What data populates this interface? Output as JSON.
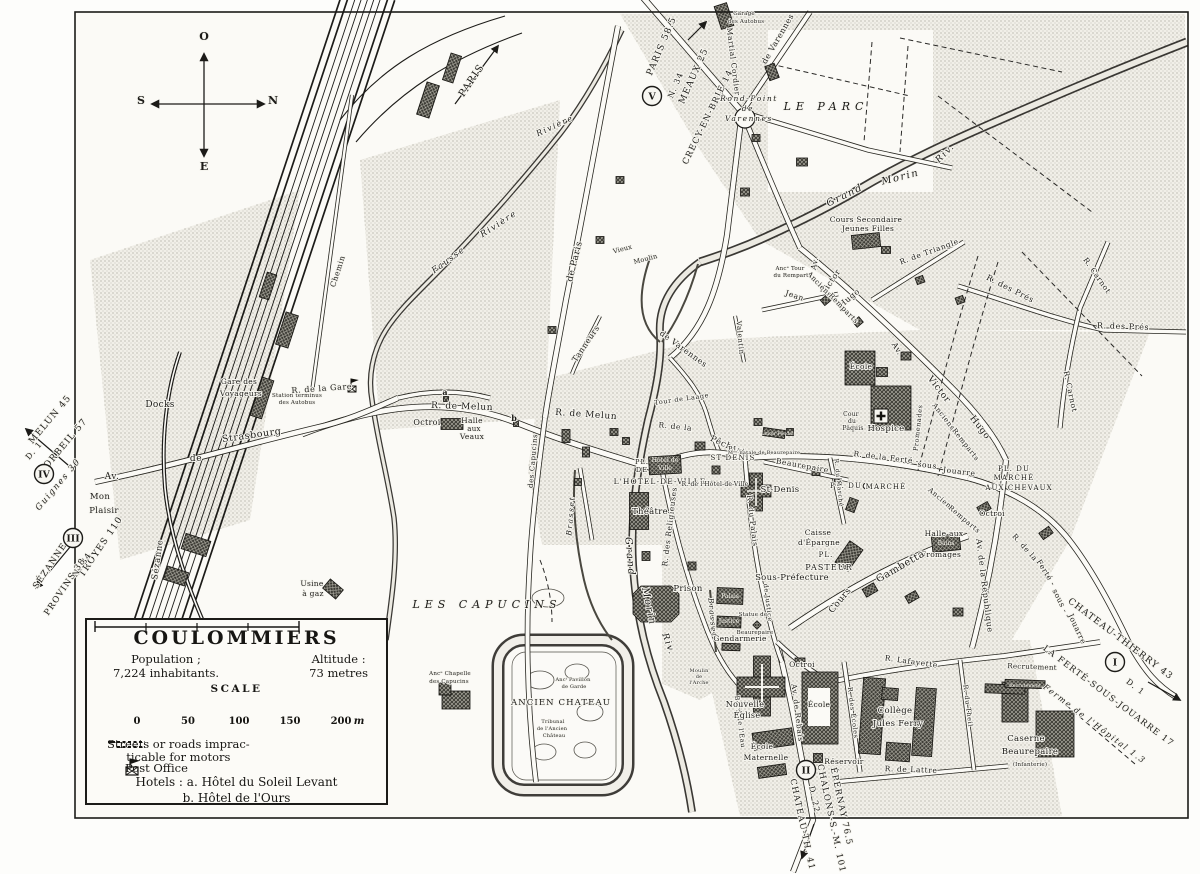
{
  "legend": {
    "title": "COULOMMIERS",
    "population_label": "Population ;",
    "population_value": "7,224 inhabitants.",
    "altitude_label": "Altitude :",
    "altitude_value": "73 metres",
    "scale_label": "SCALE",
    "scale_ticks": [
      "0",
      "50",
      "100",
      "150",
      "200"
    ],
    "scale_unit": "m",
    "impracticable_line1": "Streets or roads imprac-",
    "impracticable_line2": "ticable for motors",
    "post_office": "Post Office",
    "hotels_label": "Hotels :",
    "hotel_a": "a. Hôtel du Soleil Levant",
    "hotel_b": "b. Hôtel de l'Ours"
  },
  "compass": {
    "top": "O",
    "right": "N",
    "left": "S",
    "bottom": "E"
  },
  "map_labels": [
    [
      "MELUN 45",
      52,
      421,
      -50,
      9,
      "rt"
    ],
    [
      "CORBEIL 57",
      65,
      448,
      -50,
      9,
      "rt"
    ],
    [
      "D. 1",
      36,
      452,
      -50,
      8,
      "rt"
    ],
    [
      "Guignes 30",
      60,
      486,
      -50,
      8.5,
      "rv"
    ],
    [
      "TROYES 110",
      103,
      548,
      -56,
      9,
      "rt"
    ],
    [
      "N. 34",
      84,
      566,
      -56,
      8,
      "rt"
    ],
    [
      "SÉZANNE",
      52,
      567,
      -56,
      8.5,
      "rt"
    ],
    [
      "PROVINS 38",
      67,
      588,
      -56,
      8.5,
      "rt"
    ],
    [
      "PARIS 58.5",
      664,
      47,
      -67,
      9,
      "rt"
    ],
    [
      "N. 34",
      678,
      86,
      -67,
      8,
      "rt"
    ],
    [
      "MEAUX 25",
      696,
      77,
      -66,
      9,
      "rt"
    ],
    [
      "CRECY-EN-BRIE 14",
      710,
      118,
      -64,
      8.5,
      "rt"
    ],
    [
      "PARIS",
      474,
      82,
      -56,
      10,
      "rt"
    ],
    [
      "CHATEAU-THIERRY 43",
      1119,
      641,
      37,
      9,
      "rt"
    ],
    [
      "D. 1",
      1134,
      689,
      37,
      8,
      "rt"
    ],
    [
      "LA FERTÉ-SOUS-JOUARRE 17",
      1107,
      698,
      37,
      8.5,
      "rt"
    ],
    [
      "Ferme de l'Hôpital 1.3",
      1093,
      726,
      37,
      8,
      "rv"
    ],
    [
      "D. 22",
      812,
      800,
      78,
      8,
      "rt"
    ],
    [
      "ÉPERNAY 76.5",
      839,
      807,
      78,
      8.5,
      "rt"
    ],
    [
      "CHALONS-S.-M. 101",
      829,
      819,
      78,
      8.5,
      "rt"
    ],
    [
      "CHATEAU-TH. 41",
      800,
      825,
      78,
      8.5,
      "rt"
    ],
    [
      "I",
      1115,
      662,
      0,
      0,
      "cir"
    ],
    [
      "II",
      806,
      770,
      0,
      0,
      "cir"
    ],
    [
      "III",
      73,
      538,
      0,
      0,
      "cir"
    ],
    [
      "IV",
      44,
      474,
      0,
      0,
      "cir"
    ],
    [
      "V",
      652,
      96,
      0,
      0,
      "cir"
    ],
    [
      "O",
      204,
      40,
      0,
      11,
      "cp"
    ],
    [
      "N",
      273,
      104,
      0,
      11,
      "cp"
    ],
    [
      "S",
      141,
      104,
      0,
      11,
      "cp"
    ],
    [
      "E",
      204,
      170,
      0,
      11,
      "cp"
    ],
    [
      "Docks",
      160,
      407,
      0,
      9,
      "pl"
    ],
    [
      "Gare des",
      239,
      384,
      0,
      7.5,
      "pl"
    ],
    [
      "Voyageurs",
      241,
      396,
      0,
      7.5,
      "pl"
    ],
    [
      "Station terminus",
      297,
      397,
      0,
      5.5,
      "tn"
    ],
    [
      "des Autobus",
      297,
      404,
      0,
      5.5,
      "tn"
    ],
    [
      "R. de la Gare",
      322,
      391,
      -4,
      8,
      "rd"
    ],
    [
      "Strasbourg",
      252,
      438,
      -8,
      9.5,
      "rd"
    ],
    [
      "de",
      196,
      461,
      0,
      9,
      "rd"
    ],
    [
      "Av.",
      112,
      479,
      0,
      9,
      "rd"
    ],
    [
      "Mon",
      100,
      499,
      0,
      8.5,
      "pl"
    ],
    [
      "Plaisir",
      104,
      513,
      0,
      8.5,
      "pl"
    ],
    [
      "Sézanne",
      160,
      560,
      -82,
      8.5,
      "rd"
    ],
    [
      "Chemin",
      340,
      272,
      -72,
      7.5,
      "rd"
    ],
    [
      "Usine",
      312,
      586,
      0,
      7.5,
      "pl"
    ],
    [
      "à gaz",
      313,
      596,
      0,
      7.5,
      "pl"
    ],
    [
      "Garage",
      744,
      15,
      0,
      5.5,
      "tn"
    ],
    [
      "des Autobus",
      746,
      23,
      0,
      5.5,
      "tn"
    ],
    [
      "Fausse",
      450,
      262,
      -36,
      8.5,
      "rv"
    ],
    [
      "Rivière",
      500,
      226,
      -33,
      8.5,
      "rv"
    ],
    [
      "Rivière",
      556,
      128,
      -25,
      8,
      "rv"
    ],
    [
      "Grand",
      846,
      198,
      -26,
      10,
      "rv"
    ],
    [
      "Morin",
      901,
      180,
      -14,
      10,
      "rv"
    ],
    [
      "Riv.",
      947,
      155,
      -45,
      9,
      "rv"
    ],
    [
      "Grand",
      627,
      557,
      85,
      10,
      "rv"
    ],
    [
      "Morin",
      646,
      607,
      78,
      10,
      "rv"
    ],
    [
      "Riv.",
      666,
      645,
      70,
      9,
      "rv"
    ],
    [
      "Brasset",
      573,
      516,
      -85,
      7.5,
      "rv"
    ],
    [
      "Brasset",
      710,
      618,
      85,
      7.5,
      "rv"
    ],
    [
      "R.  de  Melun",
      462,
      409,
      2,
      9,
      "rd"
    ],
    [
      "R.  de  Melun",
      586,
      417,
      4,
      9,
      "rd"
    ],
    [
      "Octroi",
      427,
      425,
      0,
      8,
      "pl"
    ],
    [
      "Halle",
      472,
      423,
      0,
      7.5,
      "pl"
    ],
    [
      "aux",
      474,
      431,
      0,
      7,
      "pl"
    ],
    [
      "Veaux",
      472,
      439,
      0,
      7.5,
      "pl"
    ],
    [
      "a",
      445,
      395,
      0,
      8,
      "bd"
    ],
    [
      "b",
      514,
      421,
      0,
      8,
      "bd"
    ],
    [
      "de Paris",
      577,
      262,
      -76,
      9,
      "rd"
    ],
    [
      "Vieux",
      623,
      251,
      -15,
      6.5,
      "tn"
    ],
    [
      "Moulin",
      646,
      261,
      -15,
      6.5,
      "tn"
    ],
    [
      "Tanneurs",
      588,
      345,
      -56,
      8,
      "rd"
    ],
    [
      "de Varennes",
      682,
      351,
      36,
      8,
      "rd"
    ],
    [
      "Valentin",
      738,
      338,
      85,
      7,
      "rd"
    ],
    [
      "de Varennes",
      780,
      40,
      -60,
      8,
      "rd"
    ],
    [
      "Martial Cordier",
      731,
      62,
      83,
      7.5,
      "rd"
    ],
    [
      "Rond-Point",
      749,
      101,
      0,
      7.5,
      "rv"
    ],
    [
      "de",
      748,
      111,
      0,
      7.5,
      "rv"
    ],
    [
      "Varennes",
      749,
      121,
      0,
      7.5,
      "rv"
    ],
    [
      "LE PARC",
      826,
      110,
      0,
      11,
      "big"
    ],
    [
      "Cours Secondaire",
      866,
      222,
      0,
      7.5,
      "pl"
    ],
    [
      "Jeunes Filles",
      868,
      231,
      0,
      7.5,
      "pl"
    ],
    [
      "Av.",
      817,
      264,
      -78,
      7.5,
      "rd"
    ],
    [
      "Victor",
      833,
      283,
      -56,
      8,
      "rd"
    ],
    [
      "Hugo",
      851,
      300,
      -40,
      8,
      "rd"
    ],
    [
      "Anciens",
      818,
      286,
      46,
      7,
      "rd"
    ],
    [
      "Remparts",
      842,
      310,
      46,
      7,
      "rd"
    ],
    [
      "Jean",
      794,
      298,
      18,
      7.5,
      "rd"
    ],
    [
      "Ancᵉ Tour",
      790,
      270,
      0,
      5.5,
      "tn"
    ],
    [
      "du Rempart",
      791,
      277,
      0,
      5.5,
      "tn"
    ],
    [
      "R. de Triangle",
      930,
      254,
      -20,
      7.5,
      "rd"
    ],
    [
      "R. des Prés",
      1009,
      291,
      27,
      8,
      "rd"
    ],
    [
      "R. des Prés",
      1123,
      329,
      2,
      8,
      "rd"
    ],
    [
      "R. Carnot",
      1095,
      277,
      55,
      7.5,
      "rd"
    ],
    [
      "R. Carnot",
      1068,
      392,
      78,
      7.5,
      "rd"
    ],
    [
      "Tour de Laage",
      682,
      401,
      -8,
      6.5,
      "rd"
    ],
    [
      "des Capucins",
      535,
      461,
      -85,
      7,
      "rd"
    ],
    [
      "Hôtel de",
      665,
      462,
      0,
      6.2,
      "wh"
    ],
    [
      "Ville",
      665,
      470,
      0,
      6.2,
      "wh"
    ],
    [
      "PL.",
      642,
      464,
      0,
      6.5,
      "cap"
    ],
    [
      "DE",
      642,
      472,
      0,
      6.5,
      "cap"
    ],
    [
      "L'HOTEL-DE-VILLE",
      660,
      484,
      0,
      7.5,
      "cap"
    ],
    [
      "R. de l'Hôtel-de-Ville",
      715,
      486,
      0,
      6,
      "tn"
    ],
    [
      "Théâtre",
      650,
      514,
      0,
      8.5,
      "pl"
    ],
    [
      "R. de la",
      675,
      429,
      6,
      7.5,
      "rd"
    ],
    [
      "Pêcherie",
      729,
      449,
      24,
      8.5,
      "rd"
    ],
    [
      "PL.",
      735,
      451,
      0,
      6.5,
      "cap"
    ],
    [
      "ST DENIS",
      733,
      460,
      0,
      7,
      "cap"
    ],
    [
      "St-Denis",
      780,
      492,
      0,
      8.5,
      "pl"
    ],
    [
      "R. du Palais",
      750,
      521,
      83,
      7.5,
      "rd"
    ],
    [
      "Beaurepaire",
      802,
      468,
      10,
      7.5,
      "rd"
    ],
    [
      "Manoir Féodal",
      776,
      435,
      0,
      4.8,
      "wh"
    ],
    [
      "Mᵒⁿ natale de Beaurepaire",
      764,
      454,
      0,
      5,
      "tn"
    ],
    [
      "École",
      861,
      369,
      0,
      7.5,
      "pl"
    ],
    [
      "Hospice",
      886,
      431,
      0,
      8.5,
      "pl"
    ],
    [
      "Cour",
      851,
      416,
      0,
      6,
      "tn"
    ],
    [
      "du",
      852,
      423,
      0,
      6,
      "tn"
    ],
    [
      "Pâquis",
      853,
      430,
      0,
      6,
      "tn"
    ],
    [
      "Av.",
      895,
      350,
      58,
      8,
      "rd"
    ],
    [
      "Victor",
      937,
      391,
      52,
      9,
      "rd"
    ],
    [
      "Hugo",
      978,
      429,
      52,
      9,
      "rd"
    ],
    [
      "Anciens",
      942,
      418,
      52,
      7,
      "rd"
    ],
    [
      "Remparts",
      964,
      446,
      52,
      7,
      "rd"
    ],
    [
      "Promenades",
      920,
      428,
      -84,
      6.5,
      "rd"
    ],
    [
      "R. de la Ferté -",
      886,
      460,
      7,
      7.5,
      "rd"
    ],
    [
      "sous -",
      930,
      468,
      7,
      7.5,
      "rd"
    ],
    [
      "Jouarre",
      959,
      474,
      7,
      7.5,
      "rd"
    ],
    [
      "PL. DU",
      846,
      488,
      0,
      7,
      "cap"
    ],
    [
      "MARCHÉ",
      886,
      489,
      0,
      7,
      "cap"
    ],
    [
      "PL. DU",
      1014,
      471,
      0,
      7,
      "cap"
    ],
    [
      "MARCHÉ",
      1014,
      480,
      0,
      7,
      "cap"
    ],
    [
      "AUX CHEVAUX",
      1019,
      490,
      0,
      7,
      "cap"
    ],
    [
      "Octroi",
      992,
      516,
      0,
      7.5,
      "pl"
    ],
    [
      "Anciens",
      940,
      501,
      40,
      7,
      "rd"
    ],
    [
      "Remparts",
      963,
      521,
      40,
      7,
      "rd"
    ],
    [
      "Halle aux",
      944,
      536,
      0,
      7.5,
      "pl"
    ],
    [
      "Bains",
      946,
      545,
      0,
      6,
      "wh"
    ],
    [
      "Fromages",
      941,
      557,
      0,
      7.5,
      "pl"
    ],
    [
      "Av. de la République",
      982,
      586,
      83,
      8,
      "rd"
    ],
    [
      "R. de la",
      1023,
      549,
      48,
      7.5,
      "rd"
    ],
    [
      "Ferté -",
      1044,
      574,
      58,
      7.5,
      "rd"
    ],
    [
      "sous -",
      1058,
      602,
      63,
      7.5,
      "rd"
    ],
    [
      "Jouarre",
      1075,
      630,
      65,
      7.5,
      "rd"
    ],
    [
      "Cours",
      842,
      602,
      -50,
      9,
      "rd"
    ],
    [
      "Gambetta",
      902,
      569,
      -30,
      10,
      "rd"
    ],
    [
      "PL.",
      826,
      557,
      0,
      7,
      "cap"
    ],
    [
      "PASTEUR",
      829,
      570,
      0,
      8,
      "cap"
    ],
    [
      "Caisse",
      818,
      535,
      0,
      7.5,
      "pl"
    ],
    [
      "d'Épargne",
      819,
      545,
      0,
      7.5,
      "pl"
    ],
    [
      "Sous-Préfecture",
      792,
      580,
      0,
      8.5,
      "pl"
    ],
    [
      "Palais",
      730,
      598,
      0,
      6,
      "wh"
    ],
    [
      "Justice",
      729,
      623,
      0,
      6,
      "wh"
    ],
    [
      "de Justice",
      766,
      603,
      83,
      6.5,
      "rd"
    ],
    [
      "Statue de",
      753,
      616,
      0,
      5.5,
      "tn"
    ],
    [
      "Beaurepaire",
      755,
      634,
      0,
      5.5,
      "tn"
    ],
    [
      "Gendarmerie",
      740,
      641,
      0,
      7.5,
      "pl"
    ],
    [
      "Prison",
      688,
      591,
      0,
      8.5,
      "pl"
    ],
    [
      "R. des Religieuses",
      672,
      527,
      -83,
      7.5,
      "rd"
    ],
    [
      "R. du Marché",
      837,
      483,
      84,
      6,
      "rd"
    ],
    [
      "Moulin",
      699,
      672,
      0,
      5,
      "tn"
    ],
    [
      "de",
      699,
      678,
      0,
      5,
      "tn"
    ],
    [
      "l'Arche",
      699,
      684,
      0,
      5,
      "tn"
    ],
    [
      "Bord de l'Eau",
      738,
      722,
      83,
      6.5,
      "rd"
    ],
    [
      "LES CAPUCINS",
      487,
      608,
      0,
      11,
      "big"
    ],
    [
      "Ancᵉ Chapelle",
      450,
      675,
      0,
      5.5,
      "tn"
    ],
    [
      "des Capucins",
      449,
      683,
      0,
      5.5,
      "tn"
    ],
    [
      "ANCIEN CHATEAU",
      561,
      705,
      0,
      8.5,
      "cap"
    ],
    [
      "Ancᵗ Pavillon",
      573,
      681,
      0,
      5,
      "tn"
    ],
    [
      "de Garde",
      574,
      688,
      0,
      5,
      "tn"
    ],
    [
      "Tribunal",
      553,
      723,
      0,
      5,
      "tn"
    ],
    [
      "de l'Ancien",
      552,
      730,
      0,
      5,
      "tn"
    ],
    [
      "Château",
      554,
      737,
      0,
      5,
      "tn"
    ],
    [
      "Nouvelle",
      745,
      707,
      0,
      8,
      "pl"
    ],
    [
      "Église",
      747,
      718,
      0,
      8,
      "pl"
    ],
    [
      "Octroi",
      802,
      667,
      0,
      7.5,
      "pl"
    ],
    [
      "Av. de Rebais",
      795,
      713,
      83,
      7.5,
      "rd"
    ],
    [
      "École",
      819,
      707,
      0,
      7.5,
      "pl"
    ],
    [
      "École",
      762,
      749,
      0,
      7.5,
      "pl"
    ],
    [
      "Maternelle",
      766,
      760,
      0,
      7.5,
      "pl"
    ],
    [
      "Réservoir",
      844,
      764,
      0,
      7.5,
      "pl"
    ],
    [
      "R. des Écoles",
      851,
      713,
      83,
      6.5,
      "rd"
    ],
    [
      "Collège",
      895,
      713,
      0,
      8.5,
      "pl"
    ],
    [
      "Jules Ferry",
      898,
      726,
      0,
      8.5,
      "pl"
    ],
    [
      "R. Lafayette",
      911,
      664,
      8,
      7.5,
      "rd"
    ],
    [
      "R. de Lattre",
      911,
      772,
      2,
      7.5,
      "rd"
    ],
    [
      "R. du Theil",
      966,
      706,
      83,
      6.5,
      "rd"
    ],
    [
      "Caserne",
      1026,
      741,
      0,
      8.5,
      "pl"
    ],
    [
      "Beaurepaire",
      1030,
      754,
      0,
      8.5,
      "pl"
    ],
    [
      "(Infanterie)",
      1030,
      766,
      0,
      5.5,
      "tn"
    ],
    [
      "Recrutement",
      1032,
      669,
      2,
      7,
      "pl"
    ],
    [
      "Recrutement",
      1025,
      687,
      0,
      4.8,
      "wh"
    ]
  ],
  "colors": {
    "paper": "#fbfaf6",
    "ink": "#1c1b18",
    "stipple": "#a9a79d",
    "river_fill": "#eceae2",
    "building": "#3b3a34"
  }
}
